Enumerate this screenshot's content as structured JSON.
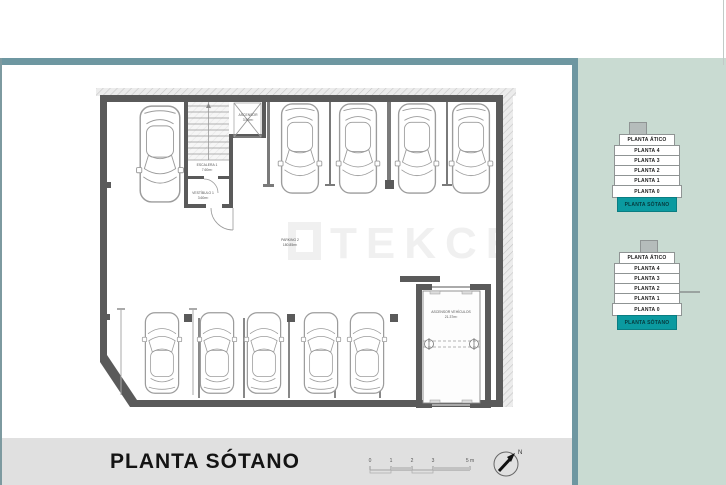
{
  "colors": {
    "frame_teal": "#6e97a1",
    "side_panel_green": "#c9dbd2",
    "active_level_teal": "#0b9aa0",
    "title_strip_gray": "#e0e0e0",
    "wall_gray": "#5a5a5a"
  },
  "title": {
    "text": "PLANTA SÓTANO"
  },
  "watermark": {
    "text": "TEKCE"
  },
  "plan": {
    "rooms": {
      "elevator": {
        "name": "ASCENSOR",
        "area": "3.50m²"
      },
      "stairs": {
        "name": "ESCALERA 1",
        "area": "7.60m²"
      },
      "vestibule": {
        "name": "VESTÍBULO 1",
        "area": "3.60m²"
      },
      "parking": {
        "name": "PARKING 2",
        "area": "180.85m²"
      },
      "car_lift": {
        "name": "ASCENSOR VEHÍCULOS",
        "area": "21.37m²"
      }
    }
  },
  "scale_bar": {
    "ticks": [
      "0",
      "1",
      "2",
      "3",
      "5 m"
    ]
  },
  "compass": {
    "label": "N"
  },
  "floor_selector": {
    "levels": [
      "PLANTA ÁTICO",
      "PLANTA 4",
      "PLANTA 3",
      "PLANTA 2",
      "PLANTA 1",
      "PLANTA 0",
      "PLANTA SÓTANO"
    ],
    "active_index": 6
  }
}
